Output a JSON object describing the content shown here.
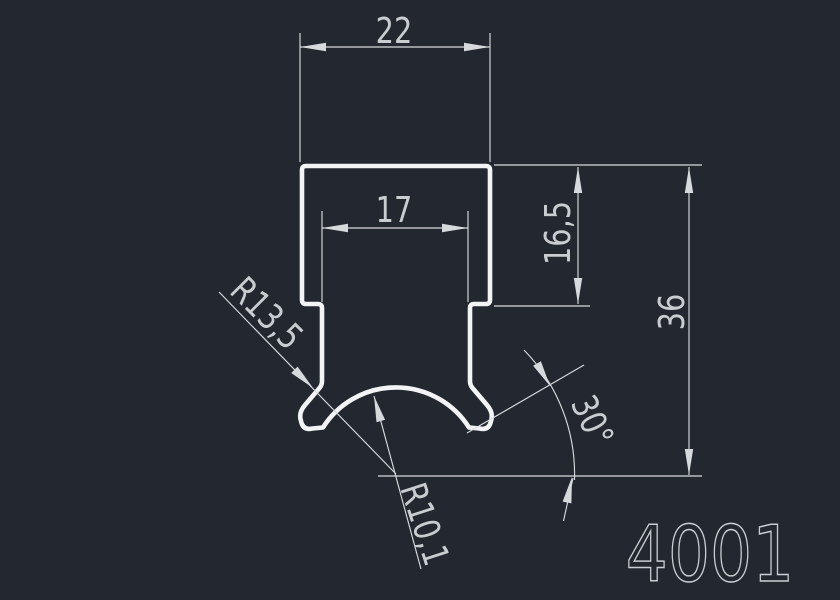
{
  "colors": {
    "background": "#232830",
    "geometry": "#f2f4f6",
    "dimension": "#d7dadd",
    "dimtext": "#c9cdd1"
  },
  "drawing": {
    "part_label": "4001",
    "dimensions": {
      "top_width": "22",
      "slot_width": "17",
      "shoulder_height": "16,5",
      "total_height": "36",
      "notch_radius": "R13,5",
      "groove_radius": "R10,1",
      "flank_angle": "30°"
    }
  }
}
